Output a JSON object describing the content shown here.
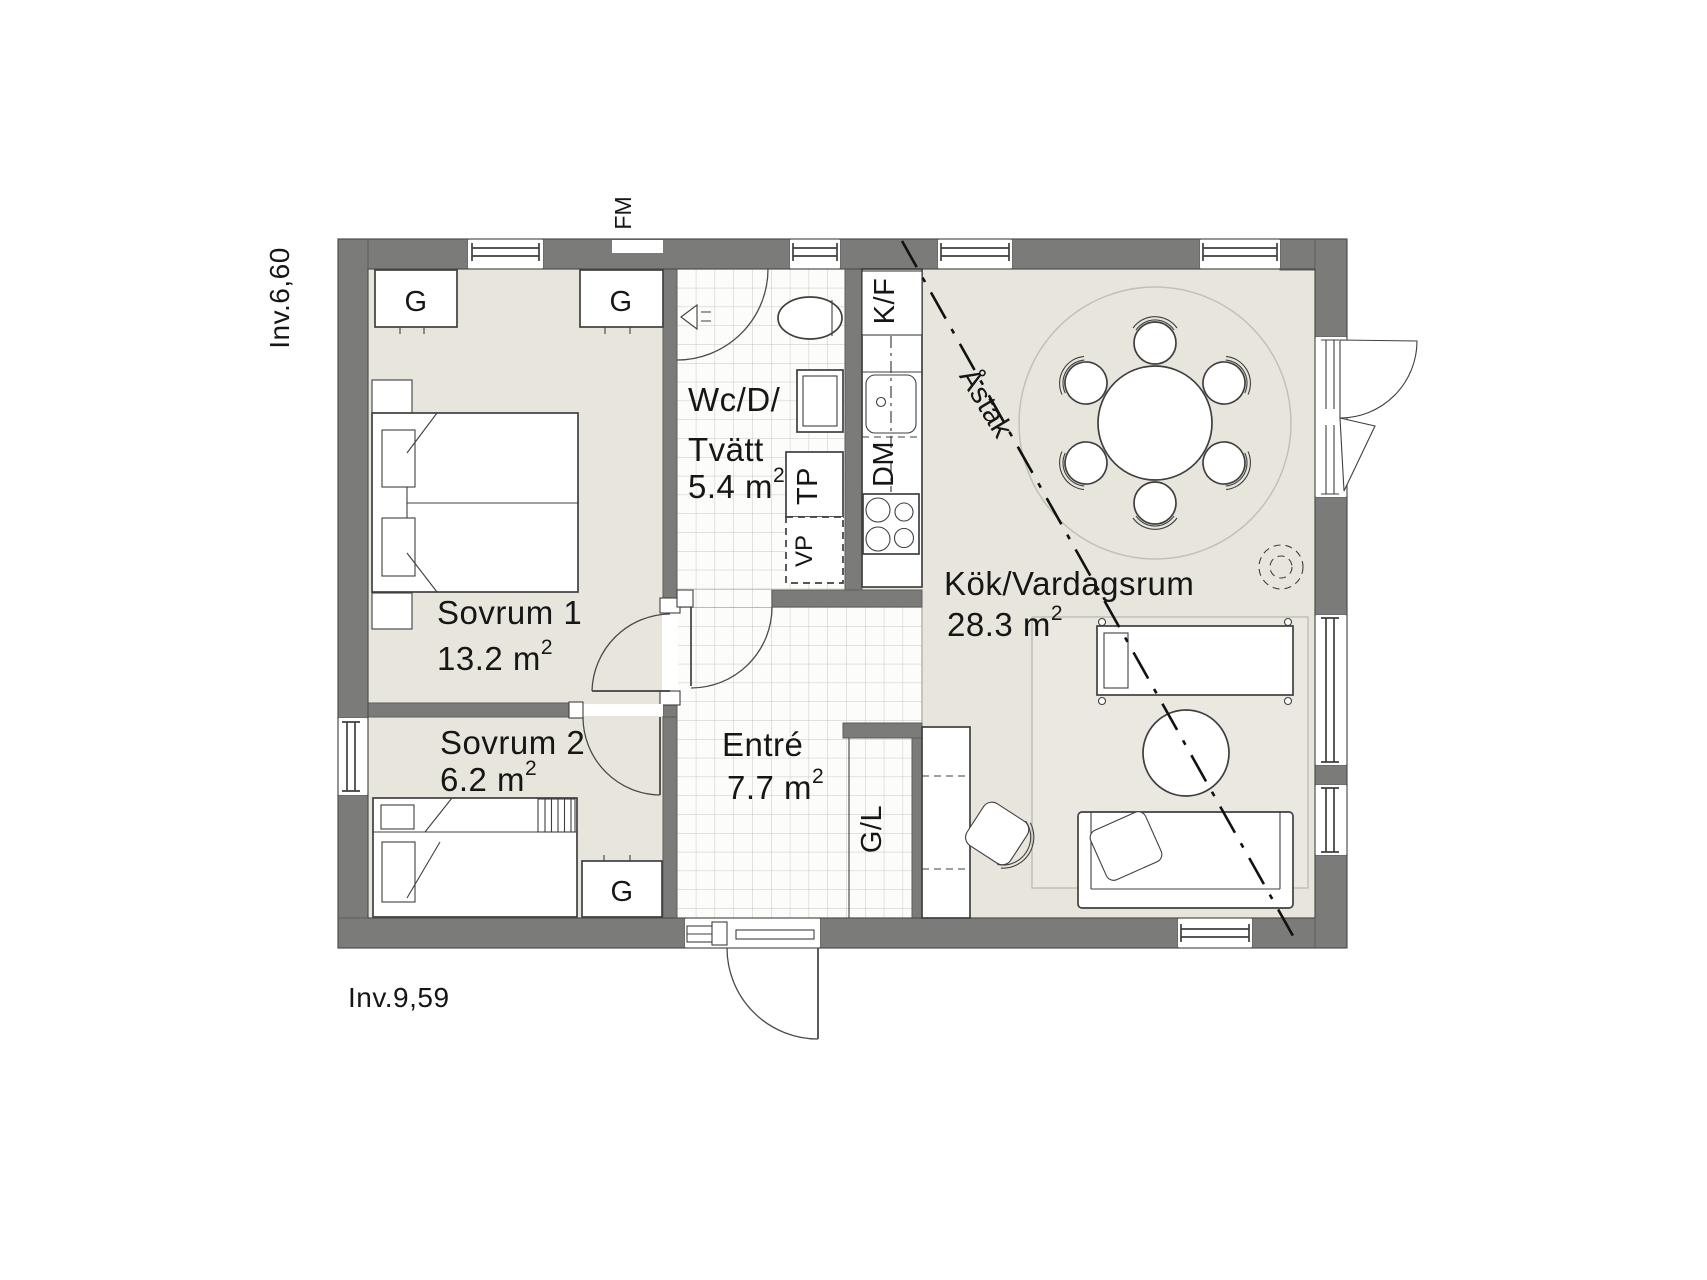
{
  "annotations": {
    "inv_top": "Inv.6,60",
    "inv_bottom": "Inv.9,59",
    "fm": "FM",
    "astak": "Åstak"
  },
  "rooms": {
    "sovrum1": {
      "name": "Sovrum 1",
      "area": "13.2 m",
      "sup": "2"
    },
    "sovrum2": {
      "name": "Sovrum 2",
      "area": "6.2 m",
      "sup": "2"
    },
    "wc": {
      "line1": "Wc/D/",
      "line2": "Tvätt",
      "area": "5.4 m",
      "sup": "2"
    },
    "entre": {
      "name": "Entré",
      "area": "7.7 m",
      "sup": "2"
    },
    "kok": {
      "name": "Kök/Vardagsrum",
      "area": "28.3 m",
      "sup": "2"
    }
  },
  "fixtures": {
    "wardrobe": "G",
    "fridge_freezer": "K/F",
    "dishwasher": "DM",
    "dryer": "TP",
    "heat_pump": "VP",
    "hall_closet": "G/L"
  },
  "colors": {
    "wall": "#7b7b7a",
    "floor": "#e8e6dc",
    "tile_bg": "#fcfcfa",
    "tile_line": "#c9c8bf",
    "line": "#3f3f3f"
  }
}
